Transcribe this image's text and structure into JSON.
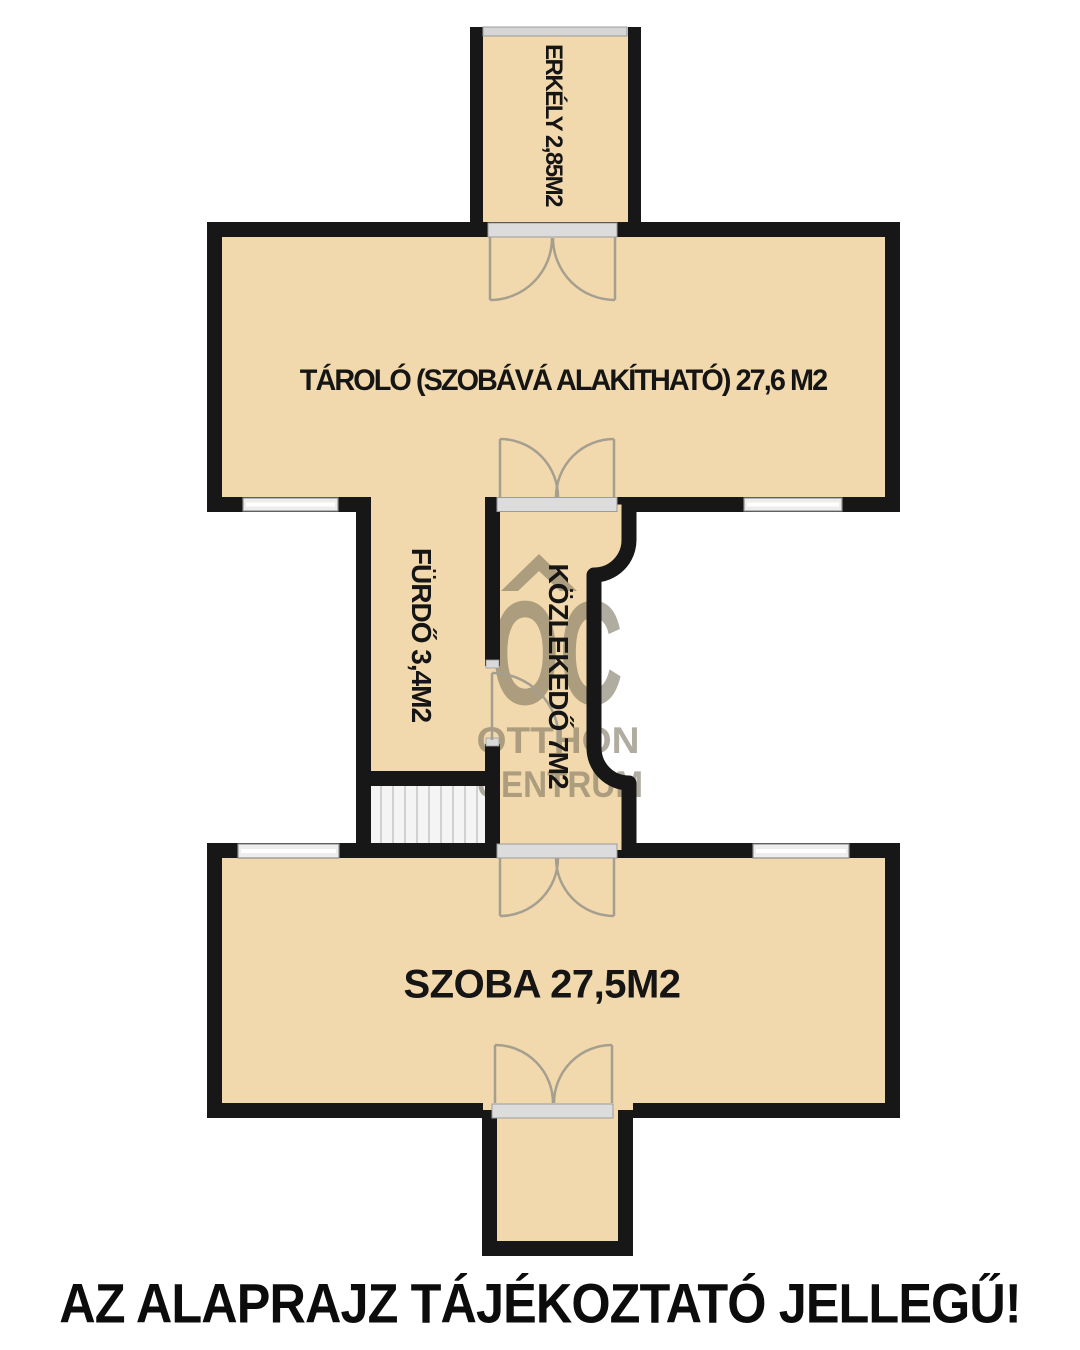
{
  "rooms": {
    "balcony": {
      "label": "ERKÉLY 2,85M2"
    },
    "storage": {
      "label": "TÁROLÓ (SZOBÁVÁ ALAKÍTHATÓ) 27,6 M2"
    },
    "bathroom": {
      "label": "FÜRDŐ 3,4M2"
    },
    "hallway": {
      "label": "KÖZLEKEDŐ 7M2"
    },
    "room": {
      "label": "SZOBA 27,5M2"
    }
  },
  "watermark": {
    "logo": "OC",
    "line1": "OTTHON",
    "line2": "CENTRUM"
  },
  "disclaimer": "AZ ALAPRAJZ TÁJÉKOZTATÓ JELLEGŰ!",
  "colors": {
    "floor": "#F2D9AD",
    "wall": "#171717",
    "opening_gray": "#DCDCDC",
    "window_gray": "#EDEDED",
    "door_arc": "#A59F8F",
    "watermark_gray": "rgba(125,116,96,0.6)"
  }
}
